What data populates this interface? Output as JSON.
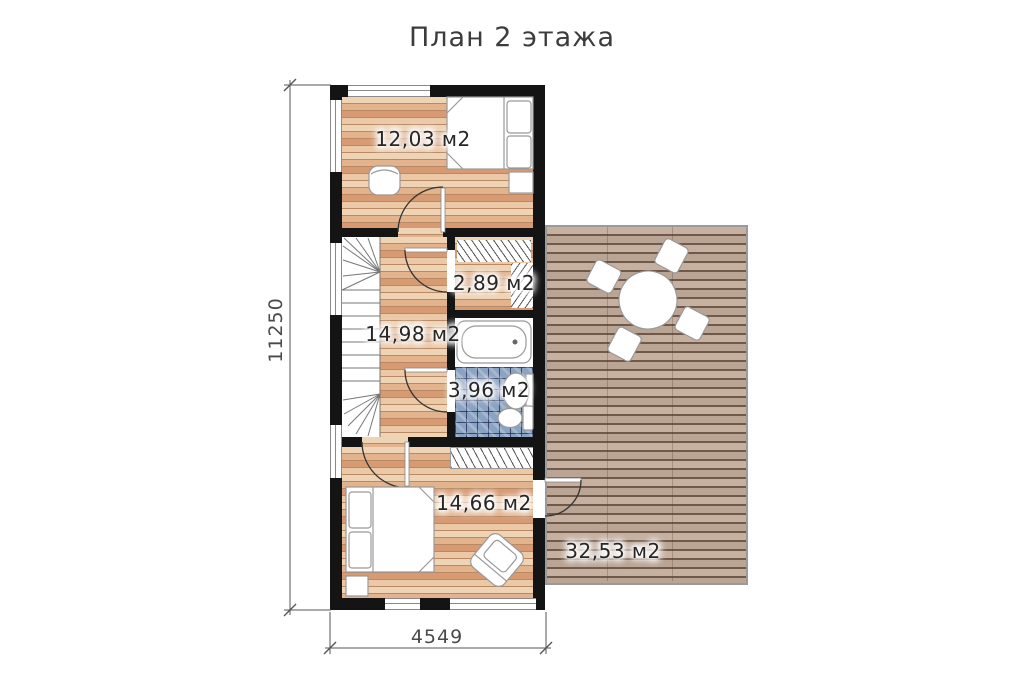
{
  "title": "План 2 этажа",
  "rooms": {
    "bedroom_top": {
      "area": "12,03 м2"
    },
    "wardrobe": {
      "area": "2,89 м2"
    },
    "hall": {
      "area": "14,98 м2"
    },
    "bathroom": {
      "area": "3,96 м2"
    },
    "bedroom_bottom": {
      "area": "14,66 м2"
    },
    "terrace": {
      "area": "32,53 м2"
    }
  },
  "dimensions": {
    "total_height_mm": "11250",
    "total_width_mm": "4549"
  },
  "colors": {
    "wall": "#141414",
    "wood_light": "#eed3b5",
    "wood_mid": "#e2b38c",
    "wood_salmon": "#d89a73",
    "wood_gap": "#b98963",
    "terrace_plank": "#c6b1a1",
    "terrace_plank_alt": "#baa494",
    "terrace_gap": "#70594a",
    "tile_blue": "#8ba3c2",
    "tile_line": "#46568a",
    "outline_gray": "#8a8a8a",
    "text": "#3c3c3c"
  }
}
